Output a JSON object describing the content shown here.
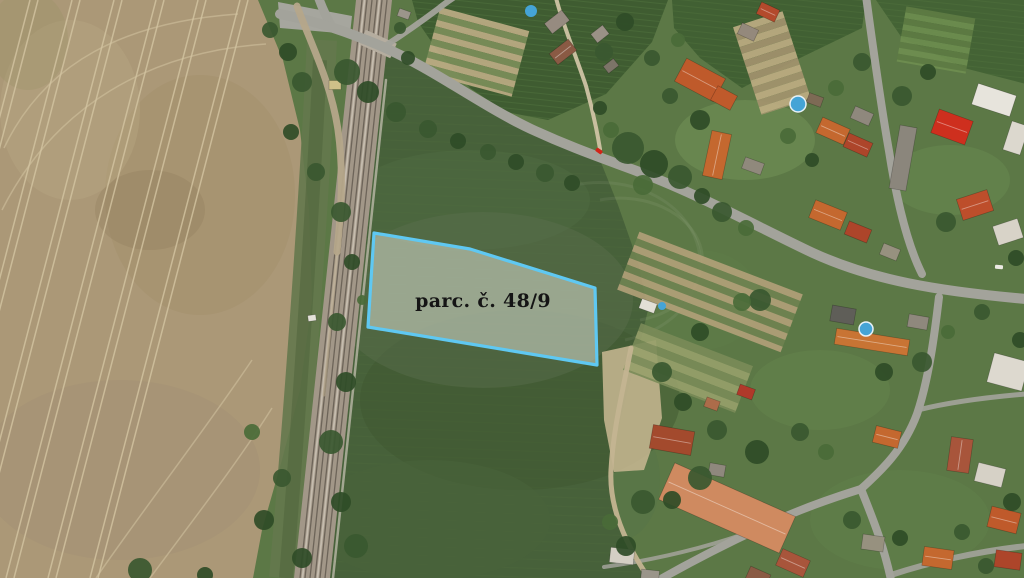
{
  "map": {
    "kind": "aerial-cadastral-view",
    "parcel_overlay": {
      "label": "parc. č. 48/9",
      "points": [
        [
          374,
          233
        ],
        [
          470,
          249
        ],
        [
          595,
          288
        ],
        [
          597,
          365
        ],
        [
          368,
          327
        ]
      ],
      "stroke": "#5fc8f2",
      "stroke_width": 3.2,
      "fill": "rgba(214,219,206,0.55)",
      "label_pos": [
        483,
        307
      ],
      "label_font_size": 19
    },
    "palette": {
      "village_green": "#5c7846",
      "field_green": "#47613a",
      "field_beige": "#ab9877",
      "road_gray": "#a3a39b",
      "rail_base": "#a29788",
      "dirt_tan": "#c2b28f",
      "pool_blue": "#45a4d6",
      "tree_colors": [
        "#3a5830",
        "#2f4c27",
        "#4a6b38"
      ]
    },
    "houses_format": "x,y,w,h,rot,roof_color,ridge",
    "houses": [
      [
        557,
        22,
        22,
        13,
        -38,
        "#968b80",
        0
      ],
      [
        563,
        52,
        24,
        14,
        -38,
        "#8a5a44",
        1
      ],
      [
        600,
        34,
        15,
        11,
        -38,
        "#9a9186",
        0
      ],
      [
        611,
        66,
        13,
        9,
        -38,
        "#7c7468",
        0
      ],
      [
        700,
        80,
        44,
        26,
        28,
        "#bf5a2b",
        1
      ],
      [
        724,
        98,
        22,
        16,
        28,
        "#bf5a2b",
        0
      ],
      [
        748,
        32,
        18,
        12,
        25,
        "#94897c",
        0
      ],
      [
        768,
        12,
        20,
        13,
        25,
        "#b34a2c",
        1
      ],
      [
        815,
        100,
        15,
        10,
        20,
        "#7d6a55",
        0
      ],
      [
        833,
        131,
        30,
        17,
        24,
        "#c4682f",
        1
      ],
      [
        858,
        145,
        26,
        15,
        24,
        "#ad452a",
        1
      ],
      [
        862,
        116,
        20,
        13,
        24,
        "#8f887d",
        0
      ],
      [
        903,
        158,
        17,
        64,
        10,
        "#8b867c",
        0
      ],
      [
        952,
        127,
        36,
        25,
        20,
        "#ce2f1e",
        1
      ],
      [
        994,
        100,
        40,
        22,
        18,
        "#e7e4dc",
        0
      ],
      [
        1016,
        138,
        18,
        30,
        18,
        "#dcd8ce",
        0
      ],
      [
        975,
        205,
        32,
        22,
        -18,
        "#bd4e2b",
        1
      ],
      [
        1008,
        232,
        26,
        20,
        -18,
        "#d8d3c8",
        0
      ],
      [
        828,
        215,
        34,
        19,
        22,
        "#c4682f",
        1
      ],
      [
        858,
        232,
        24,
        14,
        22,
        "#ad452a",
        0
      ],
      [
        890,
        252,
        18,
        12,
        22,
        "#97917f",
        0
      ],
      [
        843,
        315,
        24,
        16,
        10,
        "#5f5e58",
        0
      ],
      [
        872,
        342,
        74,
        16,
        9,
        "#c87434",
        1
      ],
      [
        918,
        322,
        20,
        13,
        10,
        "#8f887d",
        0
      ],
      [
        1008,
        372,
        36,
        30,
        15,
        "#ddd9cf",
        0
      ],
      [
        887,
        437,
        26,
        17,
        14,
        "#c4682f",
        1
      ],
      [
        990,
        475,
        28,
        19,
        14,
        "#d6d1c6",
        0
      ],
      [
        960,
        455,
        22,
        34,
        8,
        "#a8553b",
        1
      ],
      [
        1004,
        520,
        30,
        21,
        14,
        "#bf5a2b",
        1
      ],
      [
        873,
        543,
        22,
        15,
        8,
        "#97917f",
        0
      ],
      [
        938,
        558,
        30,
        19,
        8,
        "#c4682f",
        1
      ],
      [
        1008,
        560,
        26,
        17,
        8,
        "#ad452a",
        0
      ],
      [
        672,
        440,
        42,
        24,
        10,
        "#a34a2d",
        1
      ],
      [
        717,
        470,
        16,
        12,
        10,
        "#8f887d",
        0
      ],
      [
        727,
        508,
        132,
        40,
        24,
        "#cf8a60",
        1
      ],
      [
        793,
        563,
        30,
        18,
        24,
        "#a8553b",
        1
      ],
      [
        758,
        577,
        22,
        14,
        24,
        "#8a5a44",
        0
      ],
      [
        622,
        556,
        24,
        15,
        6,
        "#d4cfc4",
        0
      ],
      [
        650,
        576,
        18,
        12,
        6,
        "#9a958a",
        0
      ],
      [
        648,
        306,
        16,
        10,
        20,
        "#e2dfd6",
        0
      ],
      [
        746,
        392,
        16,
        11,
        20,
        "#b0392a",
        0
      ],
      [
        712,
        404,
        14,
        10,
        20,
        "#ac6c4a",
        0
      ],
      [
        717,
        155,
        20,
        46,
        12,
        "#c4682f",
        1
      ],
      [
        753,
        166,
        20,
        12,
        20,
        "#90897c",
        0
      ],
      [
        335,
        85,
        12,
        9,
        0,
        "#cfc089",
        0
      ],
      [
        404,
        14,
        12,
        8,
        20,
        "#9b958a",
        0
      ],
      [
        312,
        318,
        8,
        6,
        -8,
        "#e5e2da",
        0
      ]
    ],
    "trees_format": "x,y,r,color_index",
    "trees": [
      [
        347,
        72,
        13,
        0
      ],
      [
        368,
        92,
        11,
        1
      ],
      [
        396,
        112,
        10,
        0
      ],
      [
        428,
        129,
        9,
        0
      ],
      [
        458,
        141,
        8,
        1
      ],
      [
        488,
        152,
        8,
        0
      ],
      [
        516,
        162,
        8,
        1
      ],
      [
        545,
        173,
        9,
        0
      ],
      [
        572,
        183,
        8,
        1
      ],
      [
        408,
        58,
        7,
        1
      ],
      [
        400,
        28,
        6,
        0
      ],
      [
        628,
        148,
        16,
        0
      ],
      [
        654,
        164,
        14,
        1
      ],
      [
        680,
        177,
        12,
        0
      ],
      [
        643,
        185,
        10,
        2
      ],
      [
        611,
        130,
        8,
        2
      ],
      [
        600,
        108,
        7,
        1
      ],
      [
        604,
        52,
        9,
        0
      ],
      [
        625,
        22,
        9,
        1
      ],
      [
        652,
        58,
        8,
        0
      ],
      [
        678,
        40,
        7,
        2
      ],
      [
        702,
        196,
        8,
        1
      ],
      [
        722,
        212,
        10,
        0
      ],
      [
        746,
        228,
        8,
        2
      ],
      [
        760,
        300,
        11,
        0
      ],
      [
        742,
        302,
        9,
        2
      ],
      [
        700,
        332,
        9,
        1
      ],
      [
        662,
        372,
        10,
        0
      ],
      [
        683,
        402,
        9,
        1
      ],
      [
        717,
        430,
        10,
        0
      ],
      [
        757,
        452,
        12,
        1
      ],
      [
        800,
        432,
        9,
        0
      ],
      [
        826,
        452,
        8,
        2
      ],
      [
        700,
        478,
        12,
        0
      ],
      [
        672,
        500,
        9,
        1
      ],
      [
        643,
        502,
        12,
        0
      ],
      [
        626,
        546,
        10,
        1
      ],
      [
        610,
        522,
        8,
        2
      ],
      [
        852,
        520,
        9,
        0
      ],
      [
        900,
        538,
        8,
        1
      ],
      [
        962,
        532,
        8,
        0
      ],
      [
        1012,
        502,
        9,
        1
      ],
      [
        986,
        566,
        8,
        0
      ],
      [
        922,
        362,
        10,
        0
      ],
      [
        884,
        372,
        9,
        1
      ],
      [
        948,
        332,
        7,
        2
      ],
      [
        982,
        312,
        8,
        0
      ],
      [
        1020,
        340,
        8,
        1
      ],
      [
        946,
        222,
        10,
        0
      ],
      [
        1016,
        258,
        8,
        1
      ],
      [
        902,
        96,
        10,
        0
      ],
      [
        928,
        72,
        8,
        1
      ],
      [
        862,
        62,
        9,
        0
      ],
      [
        836,
        88,
        8,
        2
      ],
      [
        700,
        120,
        10,
        1
      ],
      [
        670,
        96,
        8,
        0
      ],
      [
        788,
        136,
        8,
        2
      ],
      [
        812,
        160,
        7,
        1
      ],
      [
        341,
        212,
        10,
        0
      ],
      [
        352,
        262,
        8,
        1
      ],
      [
        337,
        322,
        9,
        0
      ],
      [
        346,
        382,
        10,
        1
      ],
      [
        331,
        442,
        12,
        0
      ],
      [
        341,
        502,
        10,
        1
      ],
      [
        356,
        546,
        12,
        0
      ],
      [
        302,
        558,
        10,
        1
      ],
      [
        282,
        478,
        9,
        0
      ],
      [
        264,
        520,
        10,
        1
      ],
      [
        252,
        432,
        8,
        2
      ],
      [
        302,
        82,
        10,
        0
      ],
      [
        291,
        132,
        8,
        1
      ],
      [
        316,
        172,
        9,
        0
      ],
      [
        288,
        52,
        9,
        1
      ],
      [
        270,
        30,
        8,
        0
      ],
      [
        140,
        570,
        12,
        0
      ],
      [
        205,
        575,
        8,
        1
      ],
      [
        362,
        300,
        5,
        2
      ]
    ],
    "pools_format": "x,y,r,ring",
    "pools": [
      [
        531,
        11,
        6,
        0
      ],
      [
        798,
        104,
        8,
        1
      ],
      [
        866,
        329,
        7,
        1
      ],
      [
        662,
        306,
        4,
        0
      ]
    ],
    "vehicles_format": "x,y,w,h,rot,color",
    "vehicles": [
      [
        599,
        151,
        7,
        4,
        35,
        "#d22418"
      ],
      [
        999,
        267,
        8,
        4,
        5,
        "#eceae4"
      ]
    ],
    "roads_format": "svg path d, width, opacity",
    "roads": [
      {
        "d": "M 318,-4 C 322,8 327,18 332,27",
        "w": 9
      },
      {
        "d": "M 280,14 C 320,22 350,33 381,46 C 432,68 482,106 531,129 C 572,148 602,158 642,173 C 702,196 762,229 813,253 C 872,280 936,291 1026,299",
        "w": 10
      },
      {
        "d": "M 866,-4 C 872,40 880,100 889,151 C 896,196 906,242 922,274",
        "w": 8
      },
      {
        "d": "M 939,297 C 935,331 929,379 917,414 C 904,449 882,470 861,489",
        "w": 8
      },
      {
        "d": "M 861,489 C 870,512 883,542 891,580",
        "w": 8
      },
      {
        "d": "M 861,489 C 829,499 790,513 758,529 C 726,544 696,559 659,580",
        "w": 8
      },
      {
        "d": "M 758,529 C 712,546 660,559 604,567",
        "w": 4,
        "o": 0.85
      },
      {
        "d": "M 891,575 C 930,562 980,551 1026,546",
        "w": 6,
        "o": 0.9
      },
      {
        "d": "M 918,410 C 950,402 990,397 1026,394",
        "w": 5,
        "o": 0.9
      },
      {
        "d": "M 385,46 C 405,33 422,21 438,9 C 444,4 450,0 453,-2",
        "w": 6,
        "o": 0.95
      }
    ],
    "dirt_paths": [
      {
        "d": "M 297,6 C 310,42 331,82 338,130 C 344,172 341,212 337,252",
        "w": 7,
        "c": "#b5a78a"
      },
      {
        "d": "M 337,252 C 333,300 328,350 324,395",
        "w": 3,
        "c": "#b5a78a",
        "o": 0.6
      },
      {
        "d": "M 556,-2 C 563,25 576,56 586,86 C 593,111 597,131 600,149",
        "w": 4,
        "c": "#cfc3a4"
      },
      {
        "d": "M 631,348 C 623,390 613,430 611,470 C 609,506 624,542 650,580",
        "w": 5,
        "c": "#c4b491"
      },
      {
        "d": "M 386,80 C 368,250 350,420 333,578",
        "w": 2.5,
        "c": "#cbc4b6",
        "o": 0.7
      }
    ],
    "garden_strips_format": "cx,cy,w,h,rot,stripe_px,two colors",
    "garden_strips": [
      {
        "x": 710,
        "y": 292,
        "w": 175,
        "h": 62,
        "rot": 21,
        "stripe": 7,
        "colors": [
          "#b3a179",
          "#6f8351"
        ]
      },
      {
        "x": 476,
        "y": 52,
        "w": 92,
        "h": 68,
        "rot": 15,
        "stripe": 6.5,
        "colors": [
          "#bfae86",
          "#7d8f5b"
        ]
      },
      {
        "x": 772,
        "y": 63,
        "w": 52,
        "h": 92,
        "rot": -18,
        "stripe": 7,
        "colors": [
          "#c0ae84",
          "#a5946f"
        ]
      },
      {
        "x": 936,
        "y": 40,
        "w": 70,
        "h": 56,
        "rot": 10,
        "stripe": 6,
        "colors": [
          "#5f7c44",
          "#6f8f50"
        ]
      },
      {
        "x": 688,
        "y": 368,
        "w": 120,
        "h": 50,
        "rot": 21,
        "stripe": 8,
        "colors": [
          "#7a8b58",
          "#97a06b"
        ]
      }
    ]
  }
}
